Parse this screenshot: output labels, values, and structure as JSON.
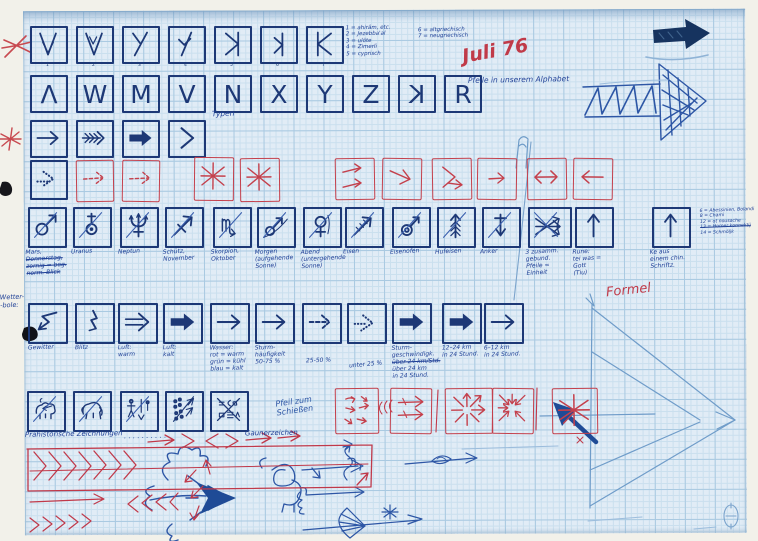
{
  "annotations": {
    "script_list_left": [
      "1 = ahirâm, etc.",
      "2 = Jezebba'al",
      "3 = ulöte",
      "4 = Zimerli",
      "5 = cyprisch"
    ],
    "script_list_right": [
      "6 = altgriechisch",
      "7 = neugriechisch"
    ],
    "date_note": "Juli 76",
    "typen_label": "Typen",
    "pfeile_alphabet": "Pfeile in unserem Alphabet",
    "formel": "Formel",
    "wetter_margin": [
      "Wetter-",
      "-bole:"
    ],
    "pfeil_schiessen": [
      "Pfeil zum",
      "Schießen"
    ],
    "praehistorisch": "Prähistorische Zeichnungen",
    "praehistorisch_dots": ". . . . . . . . . .",
    "gauner": "Gaunerzeichen",
    "side_list": [
      "6 = Abessinien, Bolandi",
      "8 = Chami",
      "12 = ot nousache",
      "~13 = Homer konnektij",
      "14 = Schmöljk"
    ]
  },
  "row1": {
    "icons": [
      "v-arrow",
      "v-check",
      "y-slant",
      "y-hook",
      "k-rev-long",
      "k-rev-short",
      "k-cap"
    ],
    "numbers": [
      "1",
      "2",
      "3",
      "4",
      "5",
      "6",
      "7"
    ]
  },
  "row2": {
    "letters": [
      "Λ",
      "W",
      "M",
      "V",
      "N",
      "X",
      "Y",
      "Z",
      "K",
      "R"
    ],
    "mirrored_index": 8
  },
  "row3": {
    "icons": [
      "arrow-thin",
      "arrow-chevrons",
      "arrow-bold",
      "chevron"
    ]
  },
  "row4": {
    "blue_icon": "arrow-dotted",
    "red_icons_left": [
      "arrow-dashed",
      "arrow-dashed"
    ],
    "red_icons_mid": [
      "asterisk",
      "asterisk"
    ],
    "red_icons_right": [
      "two-arrows",
      "arrow-diag",
      "chevron-arrow",
      "arrow-small",
      "arrow-lr",
      "arrow-left"
    ]
  },
  "row5": {
    "boxes": [
      {
        "icon": "mars",
        "label_lines": [
          "Mars,",
          "~Donnerstag,",
          "~zornig = bog.",
          "~norm. Blick"
        ]
      },
      {
        "icon": "uranus",
        "label_lines": [
          "Uranus"
        ]
      },
      {
        "icon": "neptune",
        "label_lines": [
          "Neptun"
        ]
      },
      {
        "icon": "sagittarius",
        "label_lines": [
          "Schütz,",
          "November"
        ]
      },
      {
        "icon": "scorpio",
        "label_lines": [
          "Skorpion,",
          "Oktober"
        ]
      },
      {
        "icon": "mars-curve",
        "label_lines": [
          "Morgen",
          "(aufgehende",
          "Sonne)"
        ]
      },
      {
        "icon": "venus-eve",
        "label_lines": [
          "Abend",
          "(untergehende",
          "Sonne)"
        ]
      },
      {
        "icon": "iron-arrow",
        "label_lines": [
          "Eisen"
        ]
      },
      {
        "icon": "mars-ring",
        "label_lines": [
          "Eisenofen"
        ]
      },
      {
        "icon": "fir-arrow",
        "label_lines": [
          "Hufeisen"
        ]
      },
      {
        "icon": "anchor-arrow",
        "label_lines": [
          "Anker"
        ]
      },
      {
        "icon": "three-arrows",
        "label_lines": [
          "3 zusamm.",
          "gebund.",
          "Pfeile =",
          "Einheit"
        ]
      },
      {
        "icon": "arrow-up",
        "label_lines": [
          "Rune:",
          "tei was =",
          "Gott",
          "(Tiu)"
        ]
      },
      {
        "icon": "arrow-up",
        "label_lines": [
          "Ke aus",
          "einem chin.",
          "Schriftz."
        ]
      }
    ]
  },
  "row6": {
    "boxes": [
      {
        "icon": "zigzag",
        "label_lines": [
          "Gewitter"
        ]
      },
      {
        "icon": "blitz",
        "label_lines": [
          "Blitz"
        ]
      },
      {
        "icon": "arrow-double",
        "label_lines": [
          "Luft:",
          "warm"
        ]
      },
      {
        "icon": "arrow-bold",
        "label_lines": [
          "Luft:",
          "kalt"
        ]
      },
      {
        "icon": "arrow-thin",
        "label_lines": [
          "Wasser:",
          "rot = warm",
          "grün = kühl",
          "blau = kalt"
        ]
      },
      {
        "icon": "arrow-thin",
        "label_lines": [
          "Sturm-",
          "häufigkeit",
          "50-75 %"
        ]
      },
      {
        "icon": "arrow-dashed-b",
        "label_lines": [
          "25-50 %"
        ]
      },
      {
        "icon": "arrow-dotted-b",
        "label_lines": [
          "unter 25 %"
        ]
      },
      {
        "icon": "arrow-bold",
        "label_lines": [
          "Sturm-",
          "geschwindigk.",
          "~über 24 km/Std.",
          "über 24 km",
          "in 24 Stund."
        ]
      },
      {
        "icon": "arrow-bold",
        "label_lines": [
          "12–24 km",
          "in 24 Stund."
        ]
      },
      {
        "icon": "arrow-thin",
        "label_lines": [
          "6–12 km",
          "in 24 Stund."
        ]
      }
    ]
  },
  "row7": {
    "icons": [
      "bison",
      "mammoth",
      "figures",
      "dots-arrows",
      "sign-marks"
    ]
  },
  "red_row": {
    "icons": [
      "scatter-arrows",
      "arrows-right",
      "radiate-out",
      "converge-in",
      "star-arrow"
    ]
  },
  "sketches": [
    "marker-arrow-icon",
    "hatched-arrow-sketch",
    "flag-sketch",
    "construction-arrow-sketch",
    "dragon-arrow-sketch",
    "spiral-figure-sketch",
    "ornament-arrows-sketch",
    "eye-arrow-sketch",
    "red-chevron-field",
    "red-arrow-row",
    "red-arrow-cluster",
    "red-x-mark",
    "red-asterisk-mark",
    "ink-blob",
    "corner-stamp"
  ]
}
